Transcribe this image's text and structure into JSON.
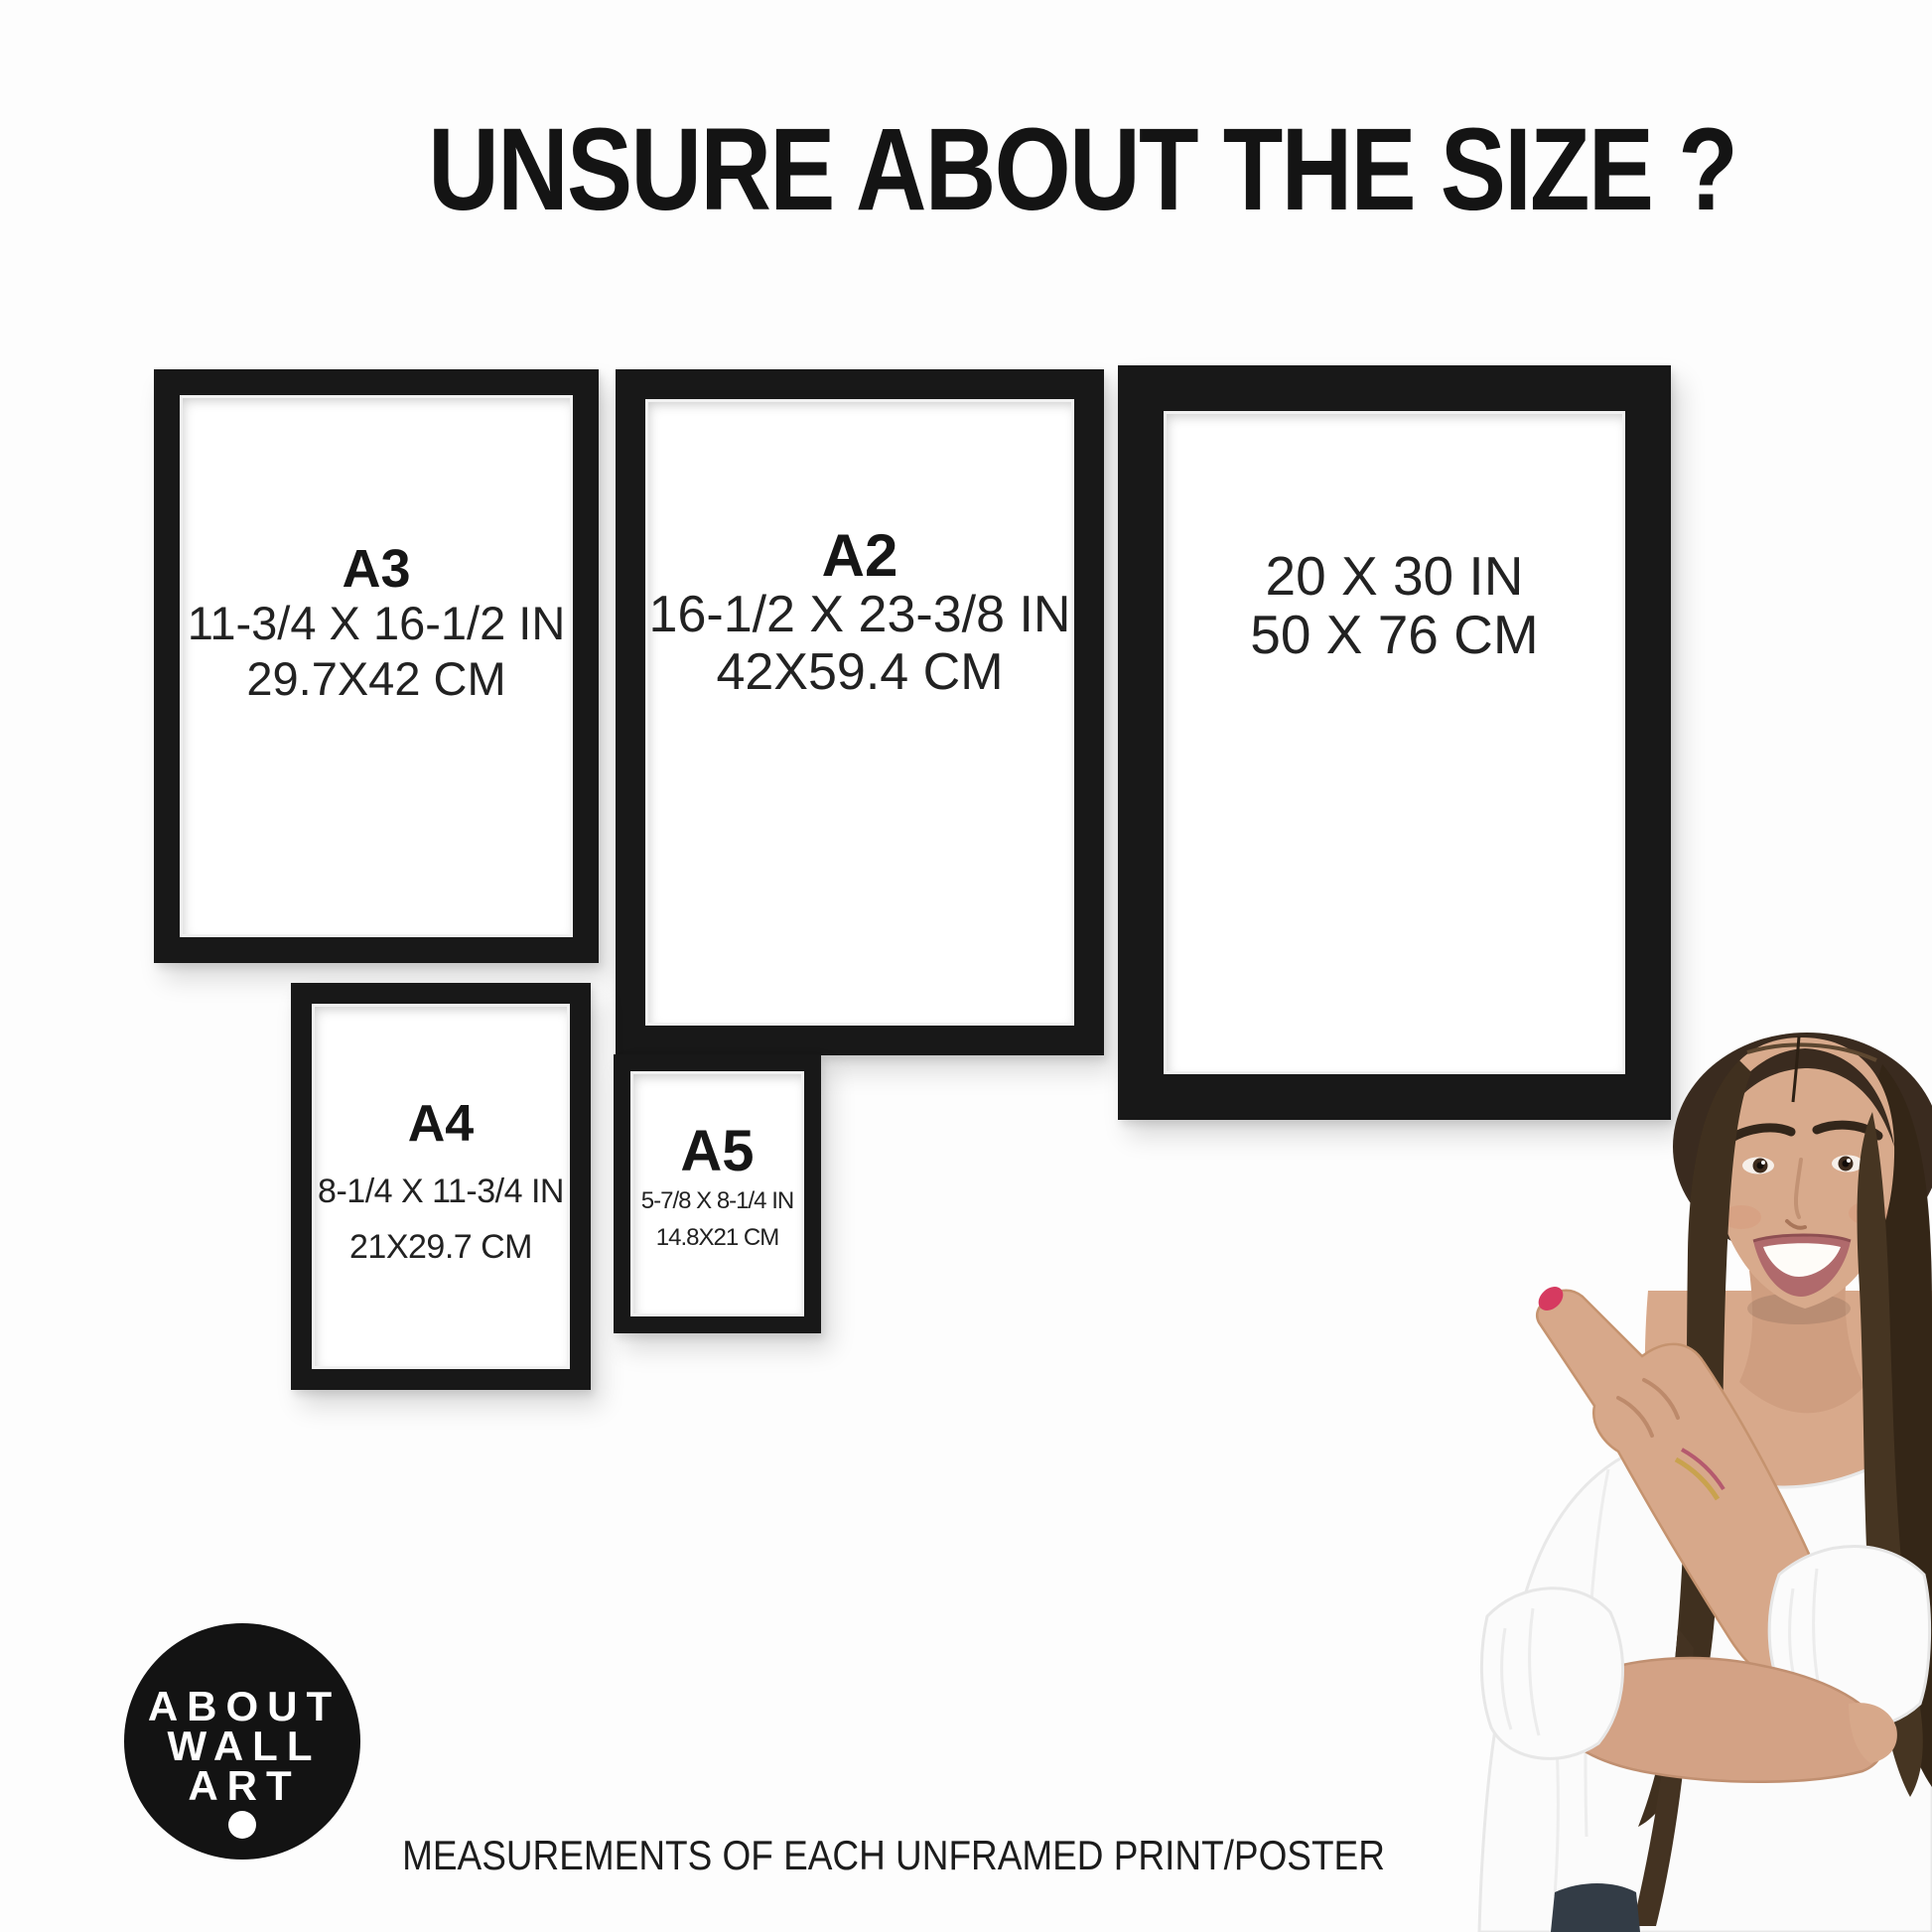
{
  "title": "UNSURE ABOUT THE SIZE ?",
  "frames": [
    {
      "name": "A3",
      "inches": "11-3/4 X 16-1/2 IN",
      "cm": "29.7X42 CM"
    },
    {
      "name": "A2",
      "inches": "16-1/2 X 23-3/8 IN",
      "cm": "42X59.4 CM"
    },
    {
      "name": "",
      "inches": "20 X 30 IN",
      "cm": "50 X 76 CM"
    },
    {
      "name": "A4",
      "inches": "8-1/4 X 11-3/4 IN",
      "cm": "21X29.7 CM"
    },
    {
      "name": "A5",
      "inches": "5-7/8 X 8-1/4 IN",
      "cm": "14.8X21 CM"
    }
  ],
  "logo": {
    "lines": [
      "ABOUT",
      "WALL",
      "ART"
    ]
  },
  "caption": "MEASUREMENTS OF EACH UNFRAMED PRINT/POSTER",
  "colors": {
    "frame_black": "#181818",
    "text": "#1d1d1d",
    "logo_background": "#131313",
    "nail_red": "#d63a60",
    "background": "#fdfdfd"
  }
}
